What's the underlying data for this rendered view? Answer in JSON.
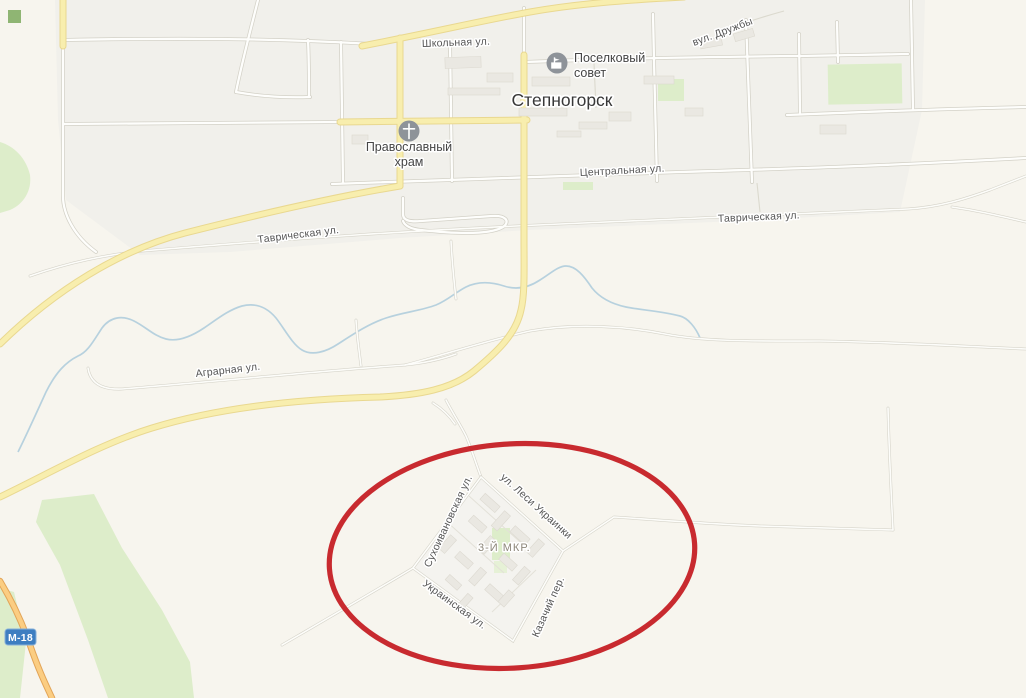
{
  "map": {
    "town_name": "Степногорск",
    "streets": {
      "shkolnaya": "Школьная ул.",
      "druzhby": "вул. Дружбы",
      "tsentralnaya": "Центральная ул.",
      "tavricheskaya": "Таврическая ул.",
      "tavricheskaya_east": "Таврическая ул.",
      "agrarnaya": "Аграрная ул.",
      "lesi_ukrainki": "ул. Леси Украинки",
      "sukhoivanovskaya": "Сухоивановская ул.",
      "ukrainskaya": "Украинская ул.",
      "kazachiy_per": "Казачий пер.",
      "mikroraion": "3-Й МКР."
    },
    "pois": [
      {
        "label_line1": "Поселковый",
        "label_line2": "совет",
        "icon": "government-building-icon"
      },
      {
        "label_line1": "Православный",
        "label_line2": "храм",
        "icon": "orthodox-church-icon"
      }
    ],
    "road_badge": "М-18",
    "colors": {
      "annotation_red": "#c51f24",
      "badge_blue": "#3e7ec1",
      "road_yellow": "#f8eeae",
      "highway_orange": "#fbcd82",
      "green_area": "#ddedca",
      "river_blue": "#b7d1de",
      "background": "#f7f5ee"
    }
  },
  "annotation": {
    "type": "ellipse",
    "color": "#c51f24"
  }
}
